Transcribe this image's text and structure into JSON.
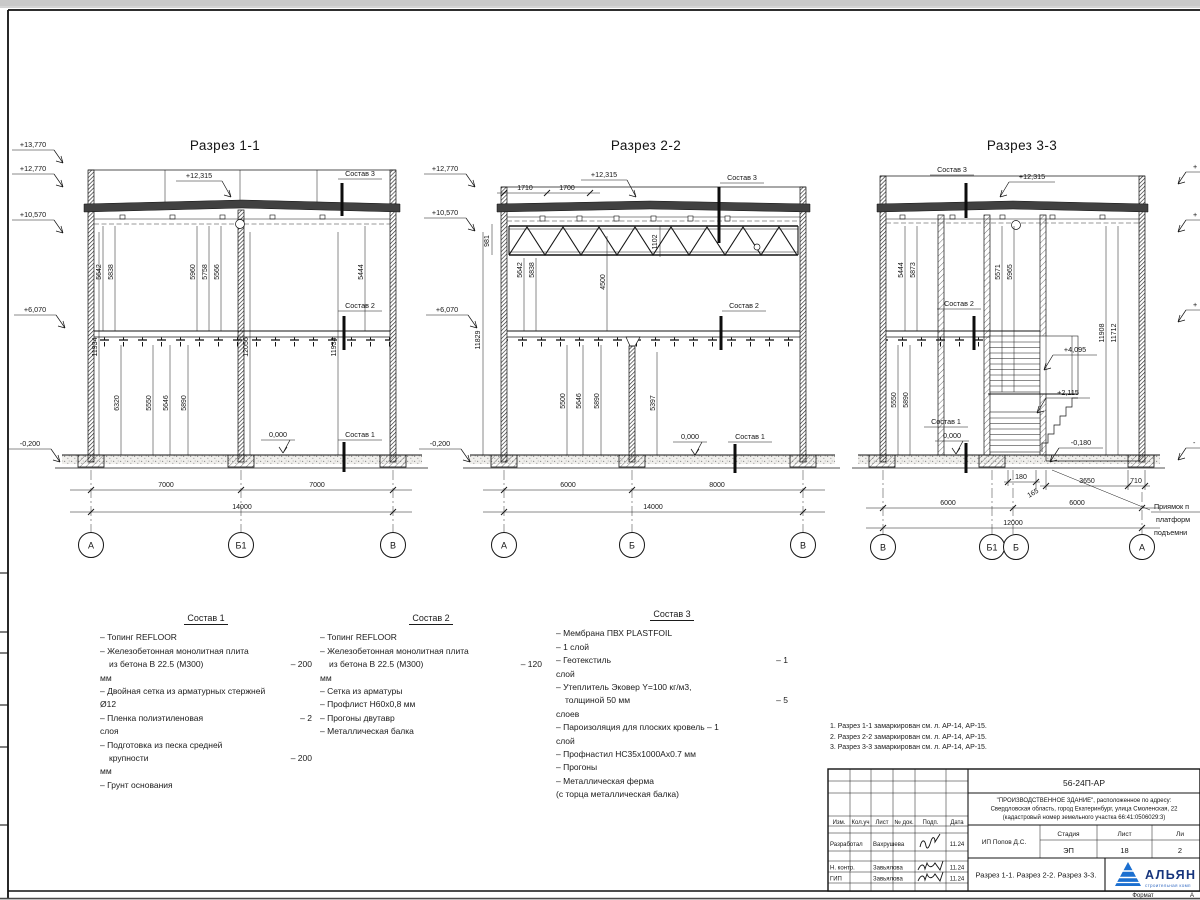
{
  "sections": {
    "s1": {
      "title": "Разрез 1-1",
      "elev": [
        "+13,770",
        "+12,770",
        "+10,570",
        "+6,070",
        "-0,200"
      ],
      "peak": "+12,315",
      "labels": {
        "c1": "Состав 1",
        "c2": "Состав 2",
        "c3": "Состав 3",
        "zero": "0,000"
      },
      "du": [
        "5642",
        "5838",
        "5960",
        "5758",
        "5566",
        "5444"
      ],
      "dm": [
        "11934",
        "12056",
        "11934"
      ],
      "dl": [
        "6320",
        "5550",
        "5646",
        "5890"
      ],
      "bd": [
        "7000",
        "7000",
        "14000"
      ],
      "axes": [
        "А",
        "Б1",
        "В"
      ]
    },
    "s2": {
      "title": "Разрез 2-2",
      "elev": [
        "+12,770",
        "+10,570",
        "+6,070",
        "-0,200"
      ],
      "peak": "+12,315",
      "top_dims": [
        "1710",
        "1700"
      ],
      "labels": {
        "c1": "Состав 1",
        "c2": "Состав 2",
        "c3": "Состав 3",
        "zero": "0,000"
      },
      "du": [
        "981",
        "5642",
        "5838",
        "4500",
        "1102",
        "11829"
      ],
      "dl": [
        "5500",
        "5646",
        "5890",
        "5397"
      ],
      "bd": [
        "6000",
        "8000",
        "14000"
      ],
      "axes": [
        "А",
        "Б",
        "В"
      ]
    },
    "s3": {
      "title": "Разрез 3-3",
      "peak": "+12,315",
      "labels": {
        "c1": "Состав 1",
        "c2": "Состав 2",
        "c3": "Состав 3",
        "zero": "0,000"
      },
      "marks": [
        "+4,095",
        "+2,115",
        "-0,180"
      ],
      "du": [
        "5444",
        "5873",
        "5571",
        "5965",
        "11908",
        "11712"
      ],
      "dl": [
        "5550",
        "5890"
      ],
      "sd": [
        "180",
        "165",
        "3650",
        "710"
      ],
      "bd": [
        "6000",
        "6000",
        "12000"
      ],
      "axes": [
        "В",
        "Б1",
        "Б",
        "А"
      ],
      "pit_note": [
        "Приямок п",
        "платформ",
        "подъемни"
      ],
      "clipped_marks": [
        "+",
        "+",
        "+",
        "-"
      ]
    }
  },
  "compositions": [
    {
      "title": "Состав 1",
      "lines": [
        {
          "l": "– Топинг REFLOOR",
          "r": ""
        },
        {
          "l": "– Железобетонная  монолитная плита",
          "r": ""
        },
        {
          "l": "из бетона В 22.5 (М300)",
          "r": "– 200"
        },
        {
          "l": "мм",
          "r": ""
        },
        {
          "l": "– Двойная сетка из арматурных стержней",
          "r": ""
        },
        {
          "l": "Ø12",
          "r": ""
        },
        {
          "l": "– Пленка полиэтиленовая",
          "r": "– 2"
        },
        {
          "l": "слоя",
          "r": ""
        },
        {
          "l": "– Подготовка из песка средней",
          "r": ""
        },
        {
          "l": "крупности",
          "r": "– 200"
        },
        {
          "l": "мм",
          "r": ""
        },
        {
          "l": "– Грунт основания",
          "r": ""
        }
      ]
    },
    {
      "title": "Состав 2",
      "lines": [
        {
          "l": "– Топинг REFLOOR",
          "r": ""
        },
        {
          "l": "– Железобетонная  монолитная плита",
          "r": ""
        },
        {
          "l": "из бетона В 22.5 (М300)",
          "r": "– 120"
        },
        {
          "l": "мм",
          "r": ""
        },
        {
          "l": "– Сетка из арматуры",
          "r": ""
        },
        {
          "l": "– Профлист Н60х0,8 мм",
          "r": ""
        },
        {
          "l": "– Прогоны двутавр",
          "r": ""
        },
        {
          "l": "– Металлическая балка",
          "r": ""
        }
      ]
    },
    {
      "title": "Состав 3",
      "lines": [
        {
          "l": "– Мембрана ПВХ PLASTFOIL",
          "r": ""
        },
        {
          "l": "– 1 слой",
          "r": ""
        },
        {
          "l": "– Геотекстиль",
          "r": "– 1"
        },
        {
          "l": "слой",
          "r": ""
        },
        {
          "l": "– Утеплитель Эковер Y=100 кг/м3,",
          "r": ""
        },
        {
          "l": "толщиной 50 мм",
          "r": "– 5"
        },
        {
          "l": "слоев",
          "r": ""
        },
        {
          "l": "– Пароизоляция для плоских кровель – 1",
          "r": ""
        },
        {
          "l": "слой",
          "r": ""
        },
        {
          "l": "– Профнастил НС35х1000Ах0.7 мм",
          "r": ""
        },
        {
          "l": "– Прогоны",
          "r": ""
        },
        {
          "l": "– Металлическая ферма",
          "r": ""
        },
        {
          "l": "(с торца металлическая балка)",
          "r": ""
        }
      ]
    }
  ],
  "notes": [
    "1. Разрез 1-1 замаркирован см. л. АР-14, АР-15.",
    "2. Разрез 2-2 замаркирован см. л. АР-14, АР-15.",
    "3. Разрез 3-3 замаркирован см. л. АР-14, АР-15."
  ],
  "titleblock": {
    "doc_number": "56-24П-АР",
    "project": [
      "\"ПРОИЗВОДСТВЕННОЕ ЗДАНИЕ\", расположенное по адресу:",
      "Свердловская область, город Екатеринбург, улица Смоленская, 22",
      "(кадастровый номер земельного участка 66:41:0506029:3)"
    ],
    "columns": [
      "Изм.",
      "Кол.уч",
      "Лист",
      "№ док.",
      "Подп.",
      "Дата"
    ],
    "rows": [
      {
        "role": "Разработал",
        "name": "Вахрушева",
        "date": "11.24"
      },
      {
        "role": "Н. контр.",
        "name": "Завьялова",
        "date": "11.24"
      },
      {
        "role": "ГИП",
        "name": "Завьялова",
        "date": "11.24"
      }
    ],
    "client": "ИП Попов Д.С.",
    "stage_label": "Стадия",
    "sheet_label": "Лист",
    "sheets_label": "Ли",
    "stage": "ЭП",
    "sheet": "18",
    "sheets": "2",
    "sheet_title": "Разрез 1-1. Разрез 2-2. Разрез 3-3.",
    "logo": {
      "name": "АЛЬЯН",
      "tagline": "строительная комп"
    },
    "format_label": "Формат",
    "format_value": "А"
  }
}
